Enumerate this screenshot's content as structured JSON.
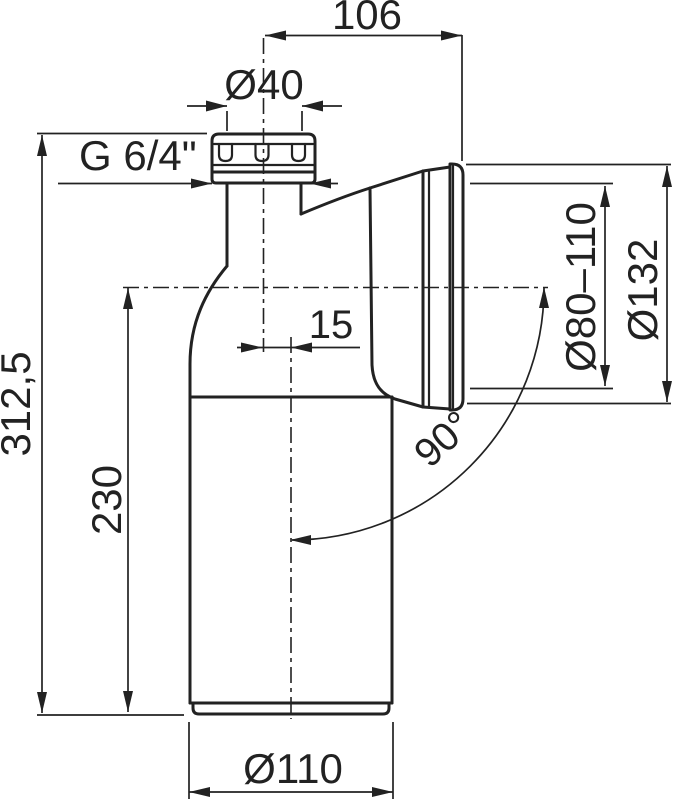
{
  "drawing": {
    "type": "technical-drawing",
    "subject": "90-degree WC connector elbow, side view with dimensions",
    "line_color": "#222222",
    "background_color": "#ffffff",
    "labels": {
      "top_width": "106",
      "inlet_diameter": "Ø40",
      "thread": "G 6/4\"",
      "axis_offset": "15",
      "total_height": "312,5",
      "outlet_axis_height": "230",
      "outlet_clamp_range": "Ø80–110",
      "outlet_flange_diameter": "Ø132",
      "bend_angle": "90°",
      "pipe_diameter": "Ø110"
    }
  }
}
